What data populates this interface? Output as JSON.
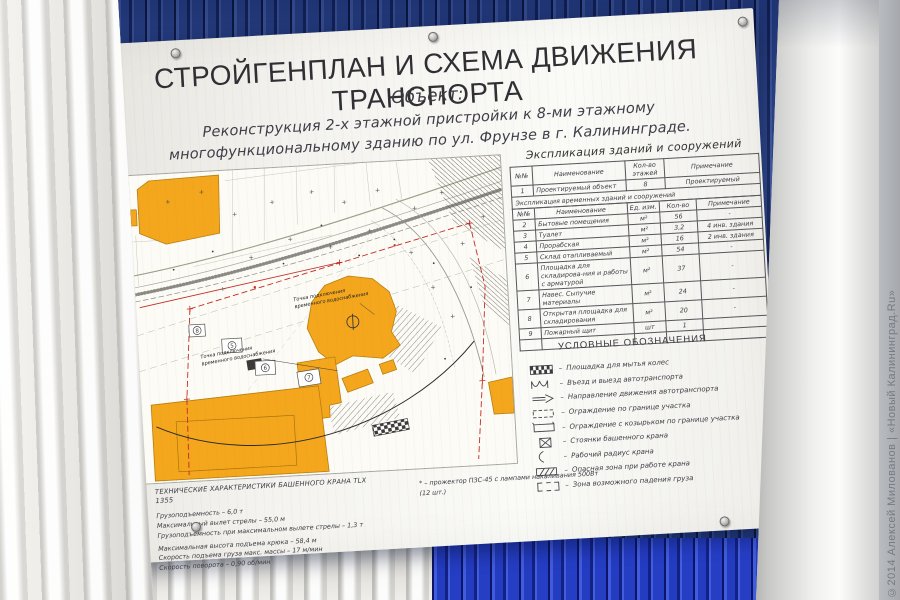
{
  "photo": {
    "watermark": "©2014 Алексей Милованов | «Новый Калининград.Ru»"
  },
  "board": {
    "title": "СТРОЙГЕНПЛАН И СХЕМА ДВИЖЕНИЯ ТРАНСПОРТА",
    "object_label": "Объект:",
    "object_line1": "Реконструкция 2-х этажной пристройки  к 8-ми этажному",
    "object_line2": "многофункциональному зданию по ул. Фрунзе в г. Калининграде."
  },
  "site_plan": {
    "water_label_line1": "Точка подключения",
    "water_label_line2": "временного водоснабжения",
    "markers": [
      "5",
      "6",
      "7",
      "8"
    ],
    "colors": {
      "building": "#f4a71d",
      "boundary": "#c32b24"
    }
  },
  "explication": {
    "title": "Экспликация зданий и сооружений",
    "table1": {
      "headers": [
        "№№",
        "Наименование",
        "Кол-во этажей",
        "Примечание"
      ],
      "rows": [
        [
          "1",
          "Проектируемый объект",
          "8",
          "Проектируемый"
        ]
      ]
    },
    "band": "Экспликация временных зданий и сооружений",
    "table2": {
      "headers": [
        "№№",
        "Наименование",
        "Ед. изм.",
        "Кол-во",
        "Примечание"
      ],
      "rows": [
        [
          "2",
          "Бытовые помещения",
          "м²",
          "56",
          "-"
        ],
        [
          "3",
          "Туалет",
          "м²",
          "3,2",
          "4 инв. здания"
        ],
        [
          "4",
          "Прорабская",
          "м²",
          "16",
          "2 инв. здания"
        ],
        [
          "5",
          "Склад отапливаемый",
          "м²",
          "54",
          "-"
        ],
        [
          "6",
          "Площадка для складирова-ния и работы с арматурой",
          "м²",
          "37",
          "-"
        ],
        [
          "7",
          "Навес. Сыпучие материалы",
          "м²",
          "24",
          "-"
        ],
        [
          "8",
          "Открытая площадка для складирования",
          "м²",
          "20",
          "-"
        ],
        [
          "9",
          "Пожарный щит",
          "шт",
          "1",
          ""
        ]
      ]
    }
  },
  "legend": {
    "title": "УСЛОВНЫЕ ОБОЗНАЧЕНИЯ",
    "dash": "–",
    "items": [
      {
        "icon": "wheel-wash-pad-icon",
        "label": "Площадка для мытья колес"
      },
      {
        "icon": "entry-exit-icon",
        "label": "Въезд и выезд автотранспорта"
      },
      {
        "icon": "traffic-direction-icon",
        "label": "Направление движения автотранспорта"
      },
      {
        "icon": "site-fence-icon",
        "label": "Ограждение по границе участка"
      },
      {
        "icon": "canopy-fence-icon",
        "label": "Ограждение с козырьком  по границе участка"
      },
      {
        "icon": "crane-stand-icon",
        "label": "Стоянки башенного крана"
      },
      {
        "icon": "crane-radius-icon",
        "label": "Рабочий радиус крана"
      },
      {
        "icon": "danger-zone-icon",
        "label": "Опасная зона при работе крана"
      },
      {
        "icon": "load-fall-zone-icon",
        "label": "Зона возможного падения груза"
      }
    ]
  },
  "crane_specs": {
    "title": "ТЕХНИЧЕСКИЕ ХАРАКТЕРИСТИКИ БАШЕННОГО КРАНА TLX 1355",
    "lines": [
      "Грузоподъемность – 6,0 т",
      "Максимальный вылет стрелы – 55,0 м",
      "Грузоподъемность при максимальном вылете стрелы – 1,3 т",
      "Максимальная высота подъема крюка – 58,4 м",
      "Скорость подъема груза макс. массы – 17 м/мин",
      "Скорость поворота – 0,90 об/мин"
    ],
    "note": "* – прожектор ПЗС-45 с лампами накаливания 500Вт (12 шт.)"
  }
}
